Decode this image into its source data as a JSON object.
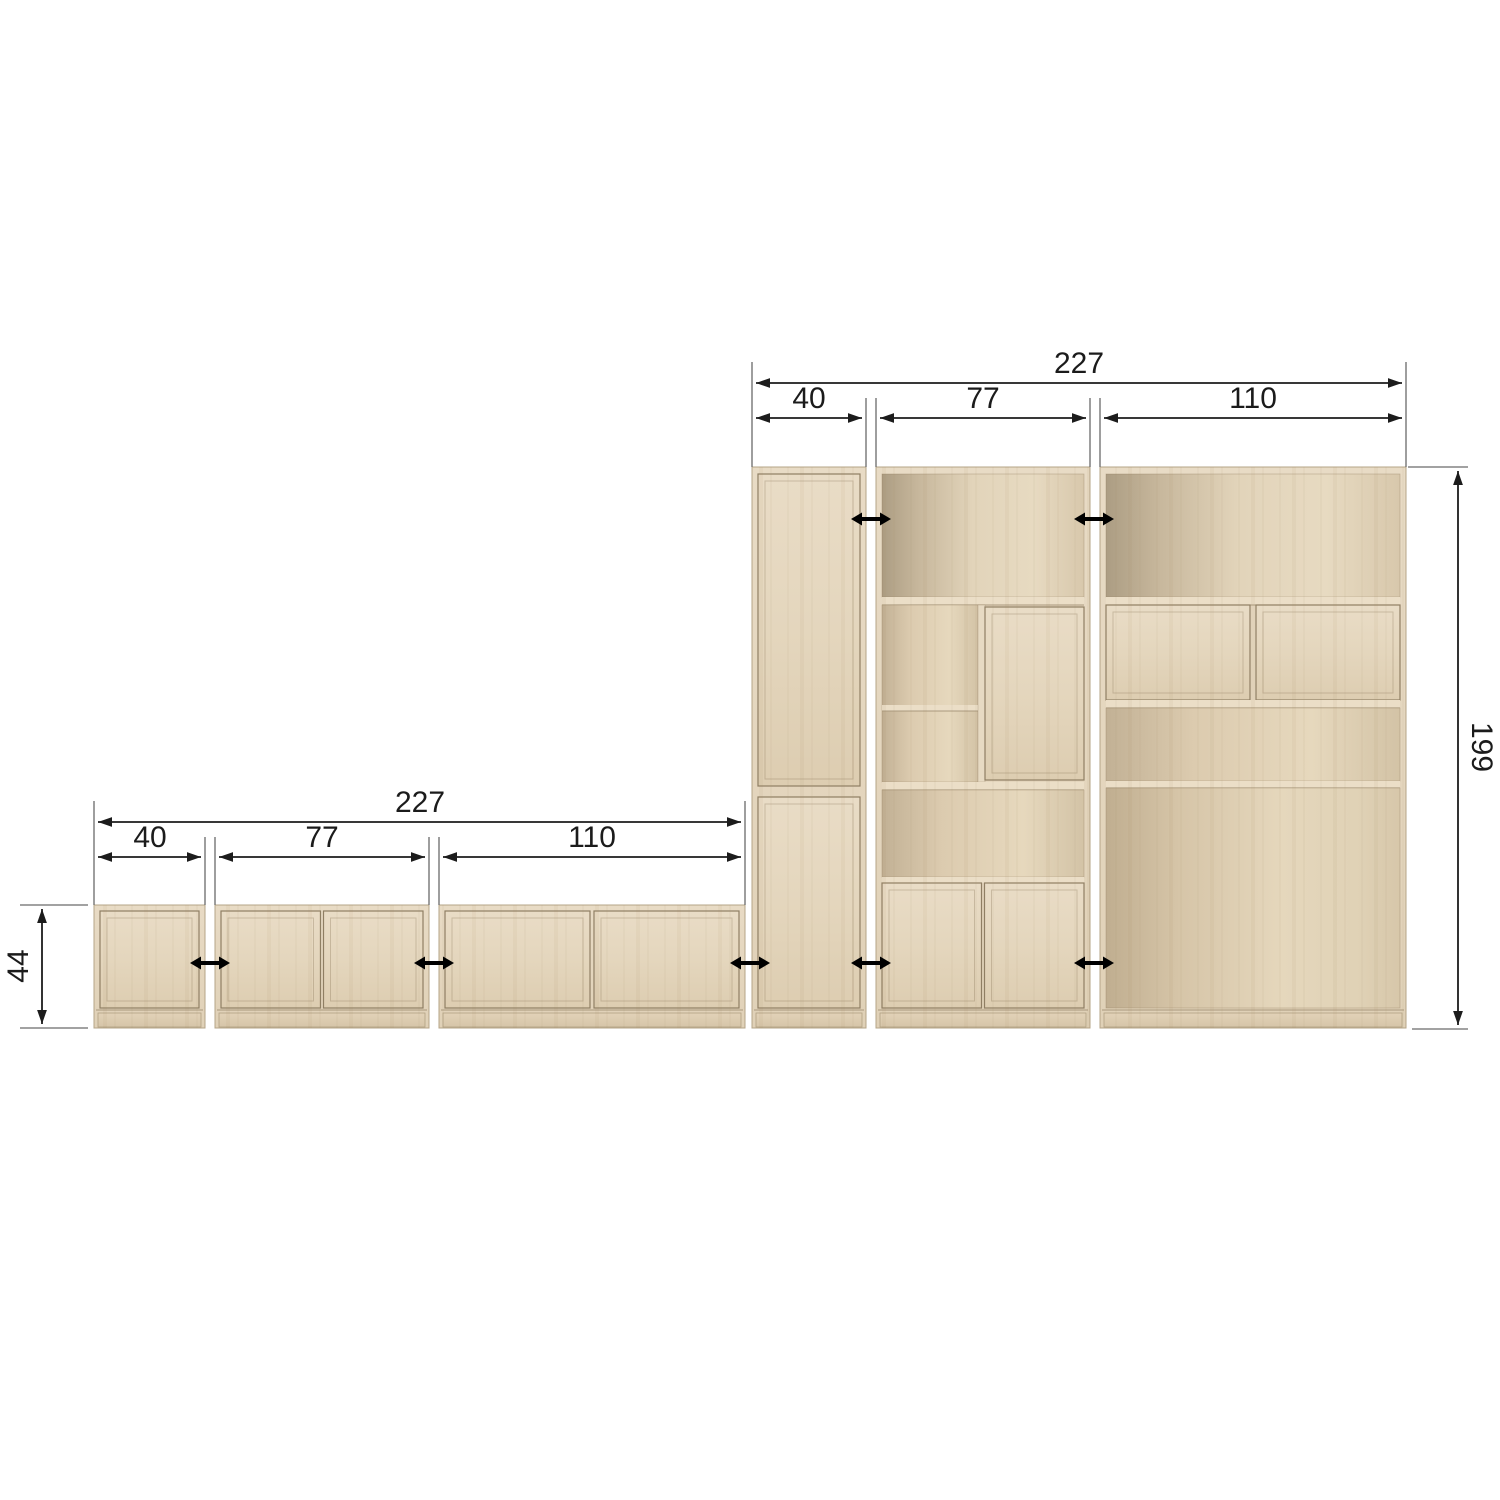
{
  "wall_unit": {
    "total_width": "227",
    "height": "199",
    "modules": [
      {
        "width": "40"
      },
      {
        "width": "77"
      },
      {
        "width": "110"
      }
    ]
  },
  "sideboard_row": {
    "total_width": "227",
    "height": "44",
    "modules": [
      {
        "width": "40"
      },
      {
        "width": "77"
      },
      {
        "width": "110"
      }
    ]
  },
  "connector_icon": "left-right-arrow",
  "colors": {
    "background": "#ffffff",
    "wood_light": "#e9dcc6",
    "wood_mid": "#e0d1b7",
    "wood_shadow": "#ac9d83",
    "door_outline": "#8f7e63",
    "dimension_line": "#1c1c1c",
    "extension_line": "#6a6a6a",
    "connector": "#000000"
  }
}
